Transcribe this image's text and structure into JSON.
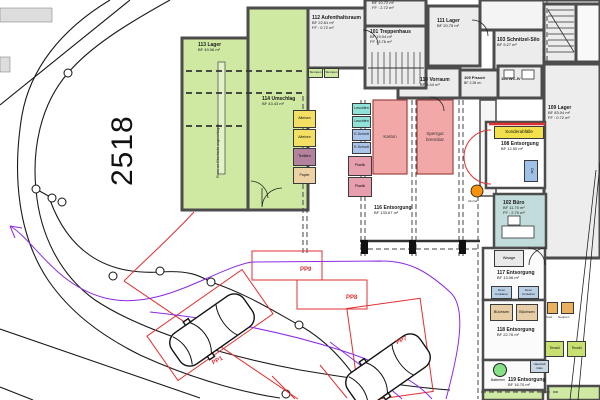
{
  "site": {
    "parcel_number": "2518"
  },
  "rooms": {
    "r113": {
      "name": "113 Lager",
      "bf": "BF 49.06 m²"
    },
    "r114": {
      "name": "114 Umschlag",
      "bf": "BF 43.43 m²"
    },
    "r112": {
      "name": "112 Aufenthaltsraum",
      "bf": "BF 22.61 m²",
      "ff": "FF : 0.72 m²"
    },
    "rtop": {
      "bf": "BF 10.72 m²",
      "ff": "FF : 2.72 m²"
    },
    "r101": {
      "name": "101 Treppenhaus",
      "bf": "BF 19.04 m²",
      "ff": "FF : 3.76 m²"
    },
    "r111": {
      "name": "111 Lager",
      "bf": "BF 20.75 m²"
    },
    "r110": {
      "name": "110 Vorraum",
      "bf": "BF 5.44 m²"
    },
    "r105": {
      "name": "105 Pissoir",
      "bf": "BF 2.28 m²"
    },
    "r104": {
      "name": "104 WC-IV"
    },
    "r103": {
      "name": "103 Schnitzel-Silo",
      "bf": "BF 9.27 m²"
    },
    "r109": {
      "name": "109 Lager",
      "bf": "BF 83.04 m²",
      "ff": "FF : 0.72 m²"
    },
    "r116": {
      "name": "116 Entsorgung",
      "bf": "BF 133.67 m²"
    },
    "r108": {
      "name": "108 Entsorgung",
      "bf": "BF 12.50 m²"
    },
    "r102": {
      "name": "102 Büro",
      "bf": "BF 11.70 m²",
      "ff": "FF : 2.70 m²"
    },
    "r117": {
      "name": "117 Entsorgung",
      "bf": "BF 13.06 m²"
    },
    "r118": {
      "name": "118 Entsorgung",
      "bf": "BF 22.76 m²"
    },
    "r119": {
      "name": "119 Entsorgung",
      "bf": "BF 16.70 m²"
    }
  },
  "containers": {
    "alteisen": "Alteisen",
    "textilien": "Textilien",
    "papier": "Papier",
    "leuchten": "Leuchten",
    "eschrott": "E-Schrott",
    "plastik": "Plastik",
    "karton": "Karton",
    "sperrgut_l1": "Sperrgut",
    "sperrgut_l2": "brennbar",
    "sonderabfaelle": "Sonderabfälle",
    "oel": "Oel",
    "waage": "Waage",
    "deco_l1": "Deco",
    "deco_l2": "Container",
    "buechsen": "Büchsen",
    "kork": "Kork",
    "neopren": "Neopren",
    "texaid": "Texaid",
    "haushalt_l1": "Haushalt",
    "haushalt_l2": "Glas",
    "stumpen": "Stumpen",
    "batterien": "Batterien",
    "alt_oel": "Alt-Oel"
  },
  "parking": {
    "pp9": "PP9",
    "pp8": "PP8",
    "pp7": "PP7",
    "pp1": "PP1"
  },
  "annotations": {
    "gutter_note": "Rinne an Oberkante angeschlagen"
  },
  "colors": {
    "room_green": "#cfe9a2",
    "zone_pink": "#f3a8a8",
    "bin_yellow": "#f2df63",
    "bin_teal": "#8fe3d8",
    "bin_blue": "#aac4ea",
    "bin_rose": "#e79fae",
    "bin_mauve": "#b3829e",
    "bin_tan": "#ecd2a4",
    "texaid_green": "#c8e070",
    "sonder_yellow": "#f2e14a",
    "buero_teal": "#c2dcdc",
    "marking_red": "#e03030",
    "sweep_purple": "#8b2be2",
    "alt_oel_orange": "#f5930c",
    "batterie_green": "#86e086"
  }
}
